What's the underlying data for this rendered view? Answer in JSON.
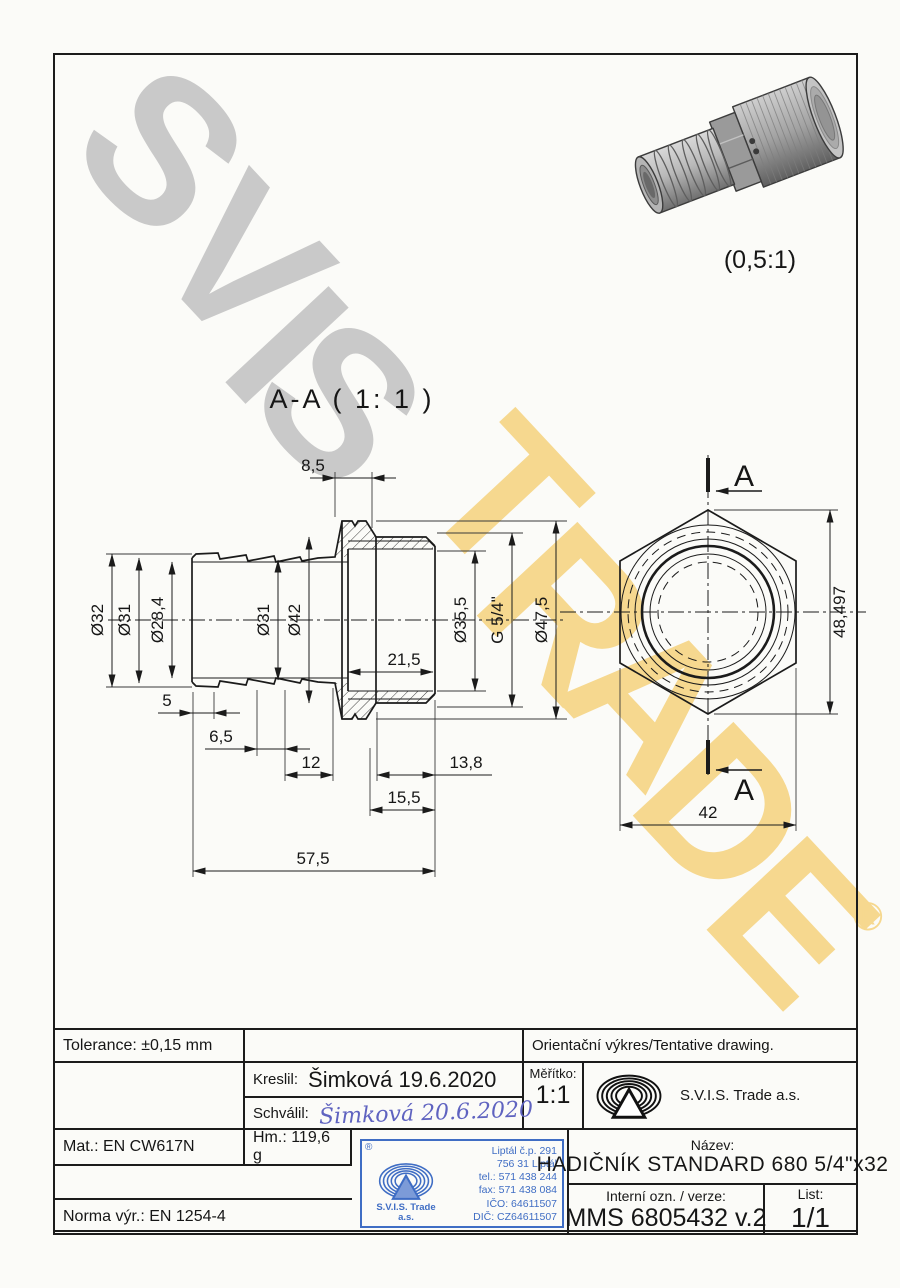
{
  "colors": {
    "line": "#1b1b1b",
    "watermark_gray": "#c9c9c9",
    "watermark_yellow": "#f6d88f",
    "stamp_blue": "#3f6dc4",
    "signature_blue": "#5f63c0"
  },
  "watermark": {
    "word1": [
      "S",
      "V",
      "I",
      "S"
    ],
    "word2": [
      "T",
      "R",
      "A",
      "D",
      "E"
    ],
    "registered": "®"
  },
  "render_3d": {
    "scale_label": "(0,5:1)"
  },
  "section_view": {
    "title": "A-A ( 1: 1 )",
    "dims": {
      "top_width": "8,5",
      "barb_od": "Ø32",
      "barb_mid": "Ø31",
      "bore": "Ø28,4",
      "tube_od": "Ø31",
      "thread_root": "Ø42",
      "socket_id": "Ø35,5",
      "thread": "G 5/4\"",
      "flange_od": "Ø47,5",
      "socket_depth": "21,5",
      "pitch1": "5",
      "pitch2": "6,5",
      "pitch3": "12",
      "thread_len": "13,8",
      "socket_len": "15,5",
      "total_len": "57,5"
    }
  },
  "end_view": {
    "across_corners": "48,497",
    "across_flats": "42",
    "cut_label": "A"
  },
  "title_block": {
    "tolerance": "Tolerance: ±0,15 mm",
    "orientacni": "Orientační výkres/Tentative drawing.",
    "kreslil_label": "Kreslil:",
    "kreslil_value": "Šimková 19.6.2020",
    "schvalil_label": "Schválil:",
    "schvalil_value": "Šimková 20.6.2020",
    "meritko_label": "Měřítko:",
    "meritko_value": "1:1",
    "company": "S.V.I.S. Trade a.s.",
    "mat": "Mat.: EN CW617N",
    "hm": "Hm.: 119,6 g",
    "nazev_label": "Název:",
    "nazev_value": "HADIČNÍK STANDARD 680 5/4\"x32",
    "interni_label": "Interní ozn. / verze:",
    "interni_value": "MMS 6805432 v.2",
    "list_label": "List:",
    "list_value": "1/1",
    "norma": "Norma výr.: EN 1254-4",
    "stamp": {
      "reg": "®",
      "company_line1": "S.V.I.S. Trade",
      "company_line2": "a.s.",
      "lines": [
        "Liptál č.p. 291",
        "756 31 Liptál",
        "tel.: 571 438 244",
        "fax: 571 438 084",
        "IČO: 64611507",
        "DIČ: CZ64611507"
      ]
    }
  }
}
